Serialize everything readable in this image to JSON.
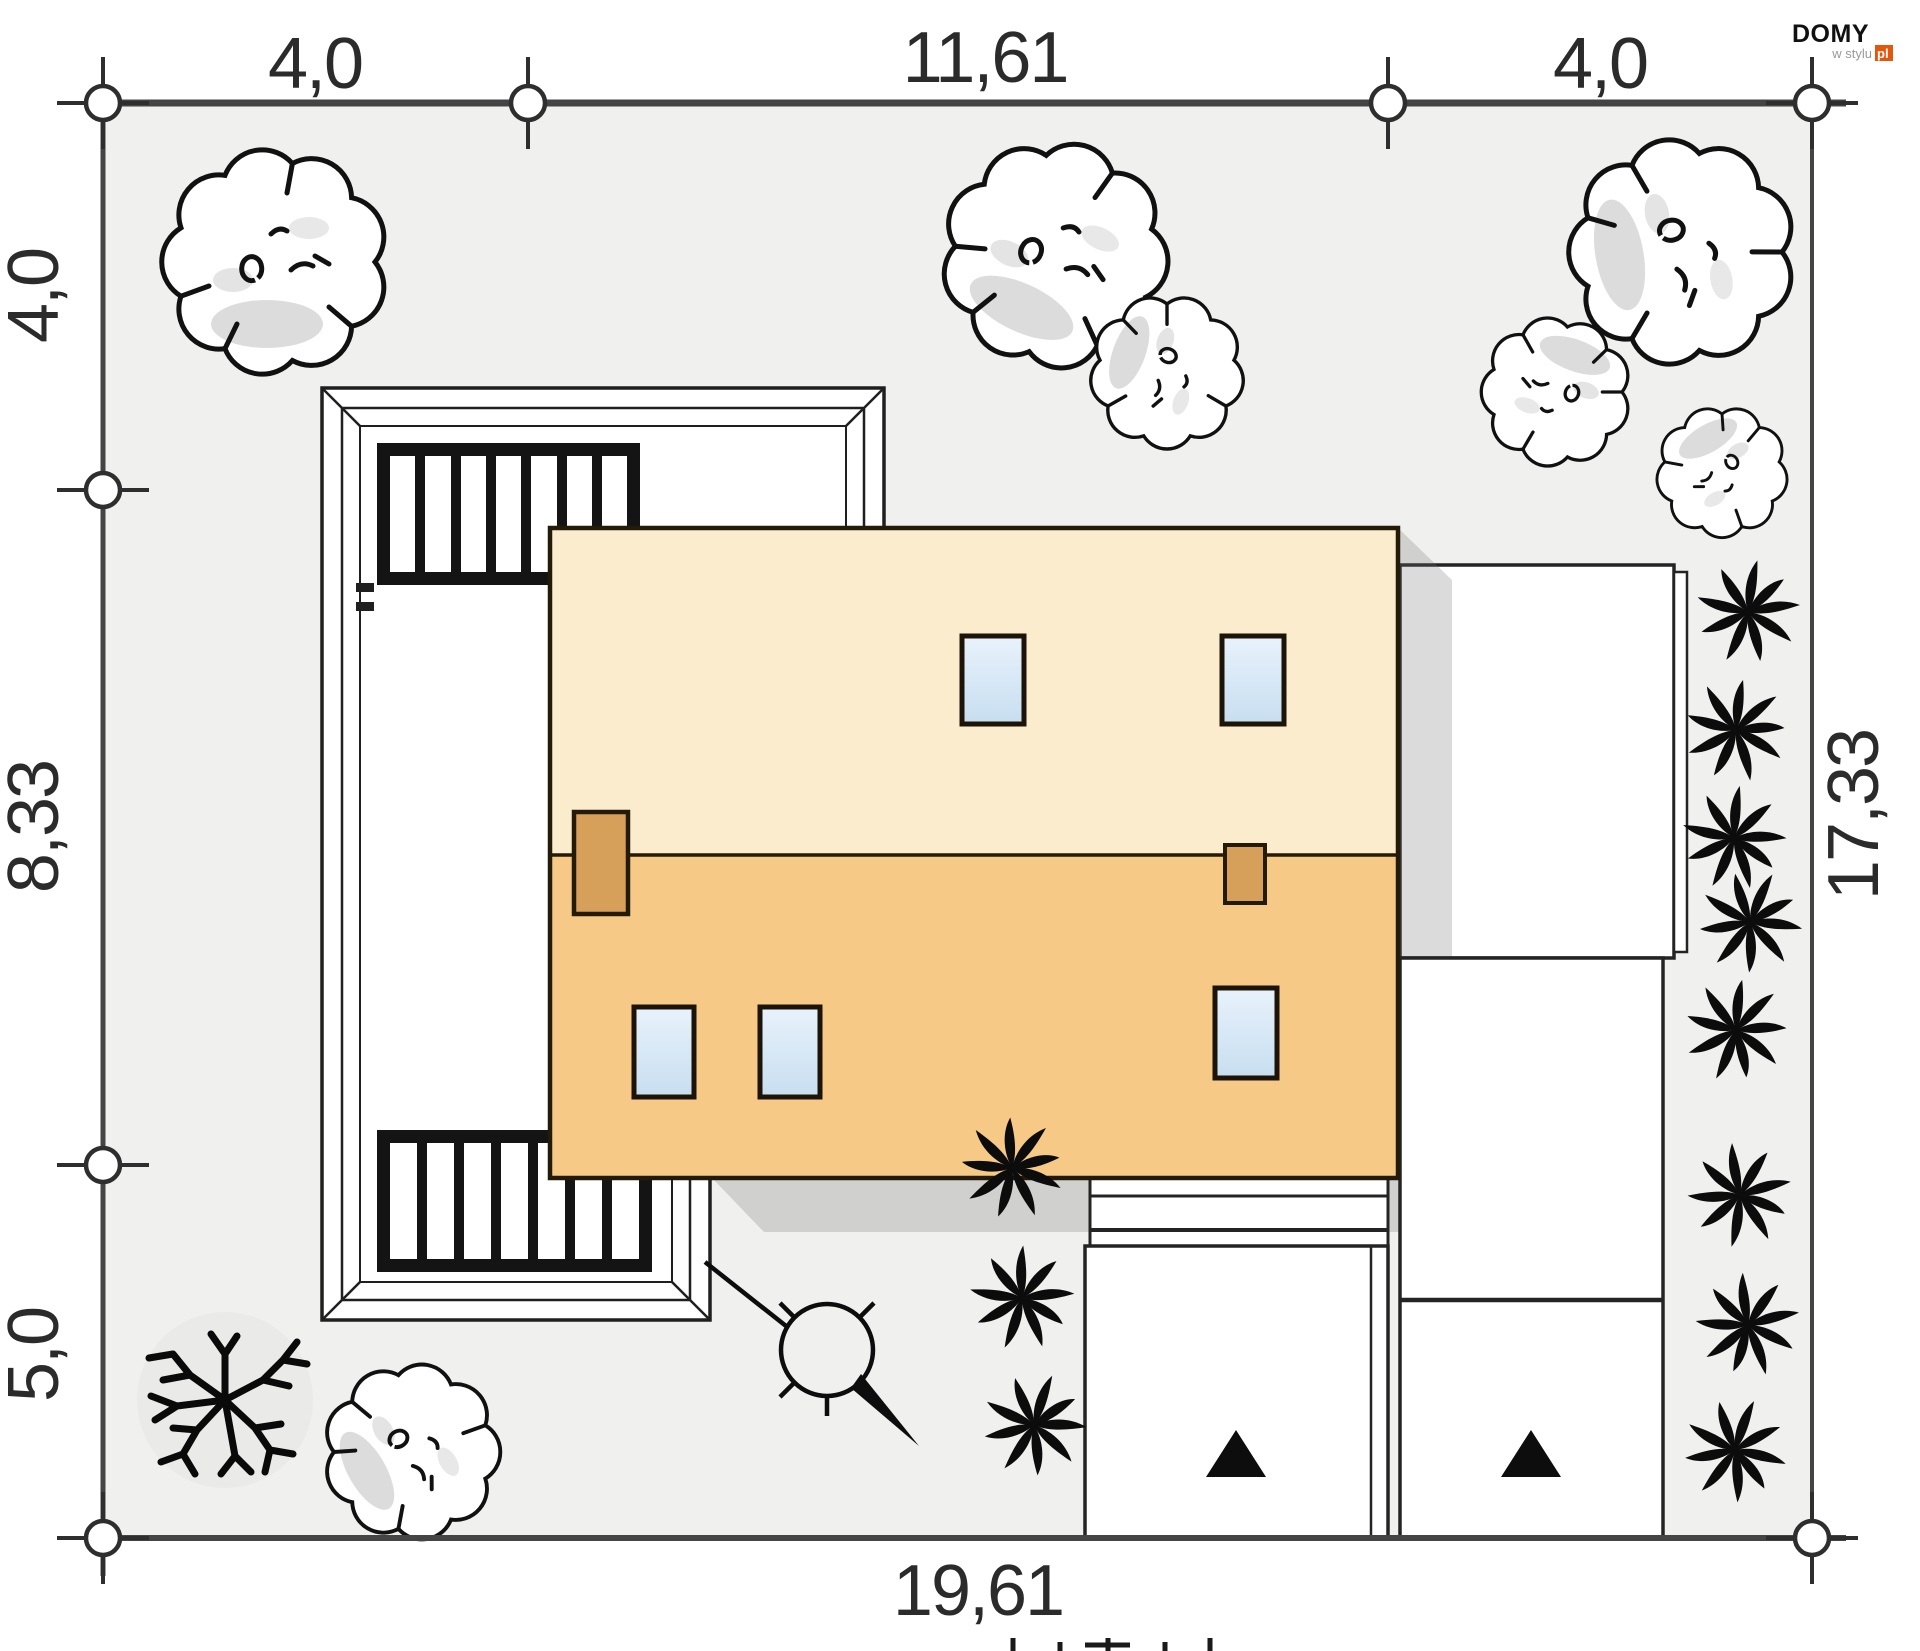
{
  "plan_type": "house site plan (roof view)",
  "dimensions": {
    "top": [
      "4,0",
      "11,61",
      "4,0"
    ],
    "left": [
      "4,0",
      "8,33",
      "5,0"
    ],
    "right": [
      "17,33"
    ],
    "bottom": [
      "19,61"
    ]
  },
  "logo": {
    "brand": "DOMY",
    "tagline": "w stylu",
    "tld": "pl",
    "accent_color": "#e4570a"
  },
  "colors": {
    "plot_fill": "#f0f0ee",
    "boundary": "#444444",
    "roof_upper": "#fbeccd",
    "roof_lower": "#f6c987",
    "chimney": "#d6a05b",
    "roof_window": "#d9eaf7",
    "shadow": "rgba(110,110,110,0.25)",
    "outline": "#241a08"
  },
  "symbols": {
    "deciduous_tree_count": 7,
    "bare_tree_count": 1,
    "shrub_count": 11,
    "entrance_arrow_count": 2,
    "lamp_post_count": 1
  }
}
